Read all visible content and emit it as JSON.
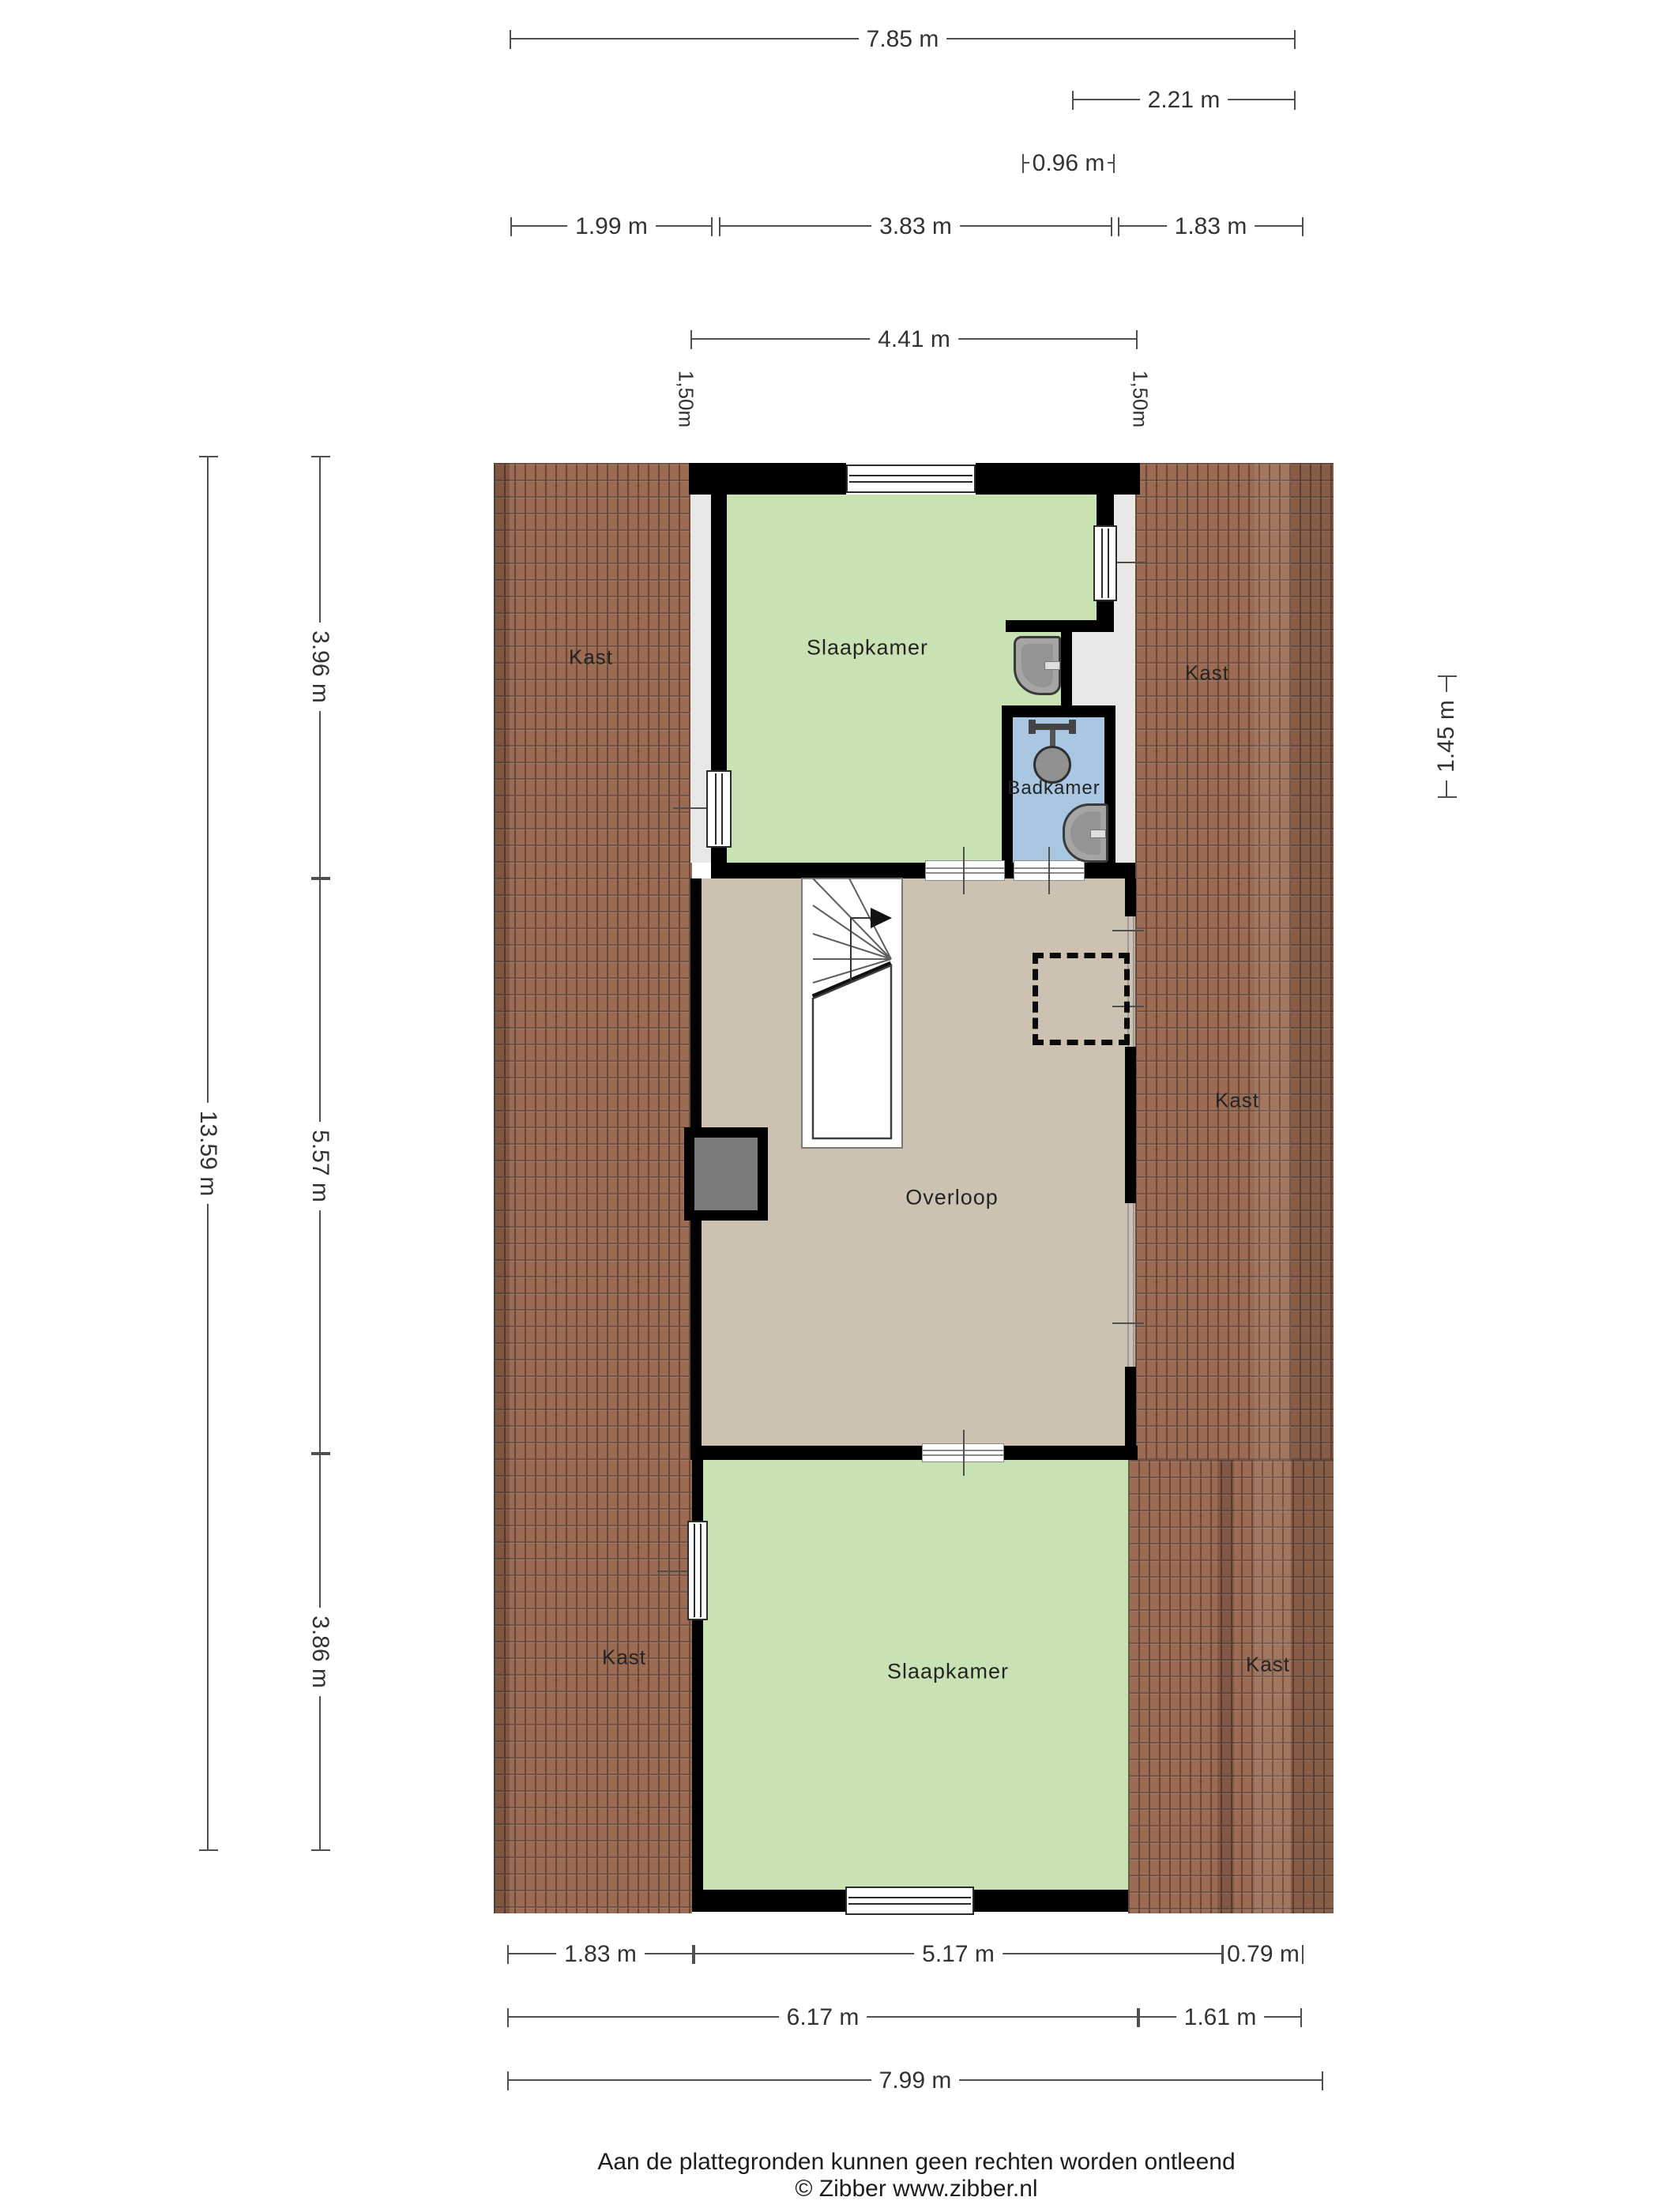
{
  "rooms": {
    "kast": "Kast",
    "slaapkamer": "Slaapkamer",
    "badkamer": "Badkamer",
    "overloop": "Overloop"
  },
  "dimensions": {
    "top": {
      "w785": "7.85 m",
      "w221": "2.21 m",
      "w096": "0.96 m",
      "w199": "1.99 m",
      "w383": "3.83 m",
      "w183": "1.83 m",
      "w441": "4.41 m",
      "v150_left": "1,50m",
      "v150_right": "1,50m"
    },
    "left": {
      "h1359": "13.59 m",
      "h396": "3.96 m",
      "h557": "5.57 m",
      "h386": "3.86 m"
    },
    "right": {
      "h145": "1.45 m"
    },
    "bottom": {
      "w183": "1.83 m",
      "w517": "5.17 m",
      "w079": "0.79 m",
      "w617": "6.17 m",
      "w161": "1.61 m",
      "w799": "7.99 m"
    }
  },
  "footer": {
    "line1": "Aan de plattegronden kunnen geen rechten worden ontleend",
    "line2": "© Zibber www.zibber.nl"
  },
  "colors": {
    "roof": "#9c6b53",
    "roof_grout": "#3f281c",
    "bedroom_green": "#c9e2b3",
    "landing_tan": "#cdc2b1",
    "bathroom_blue": "#a9c7e2",
    "floor_strip": "#e9e8e6",
    "wall": "#000000",
    "chimney_fill": "#7b7b7b",
    "dimension_line": "#4f4f4f",
    "dimension_text": "#333333"
  }
}
